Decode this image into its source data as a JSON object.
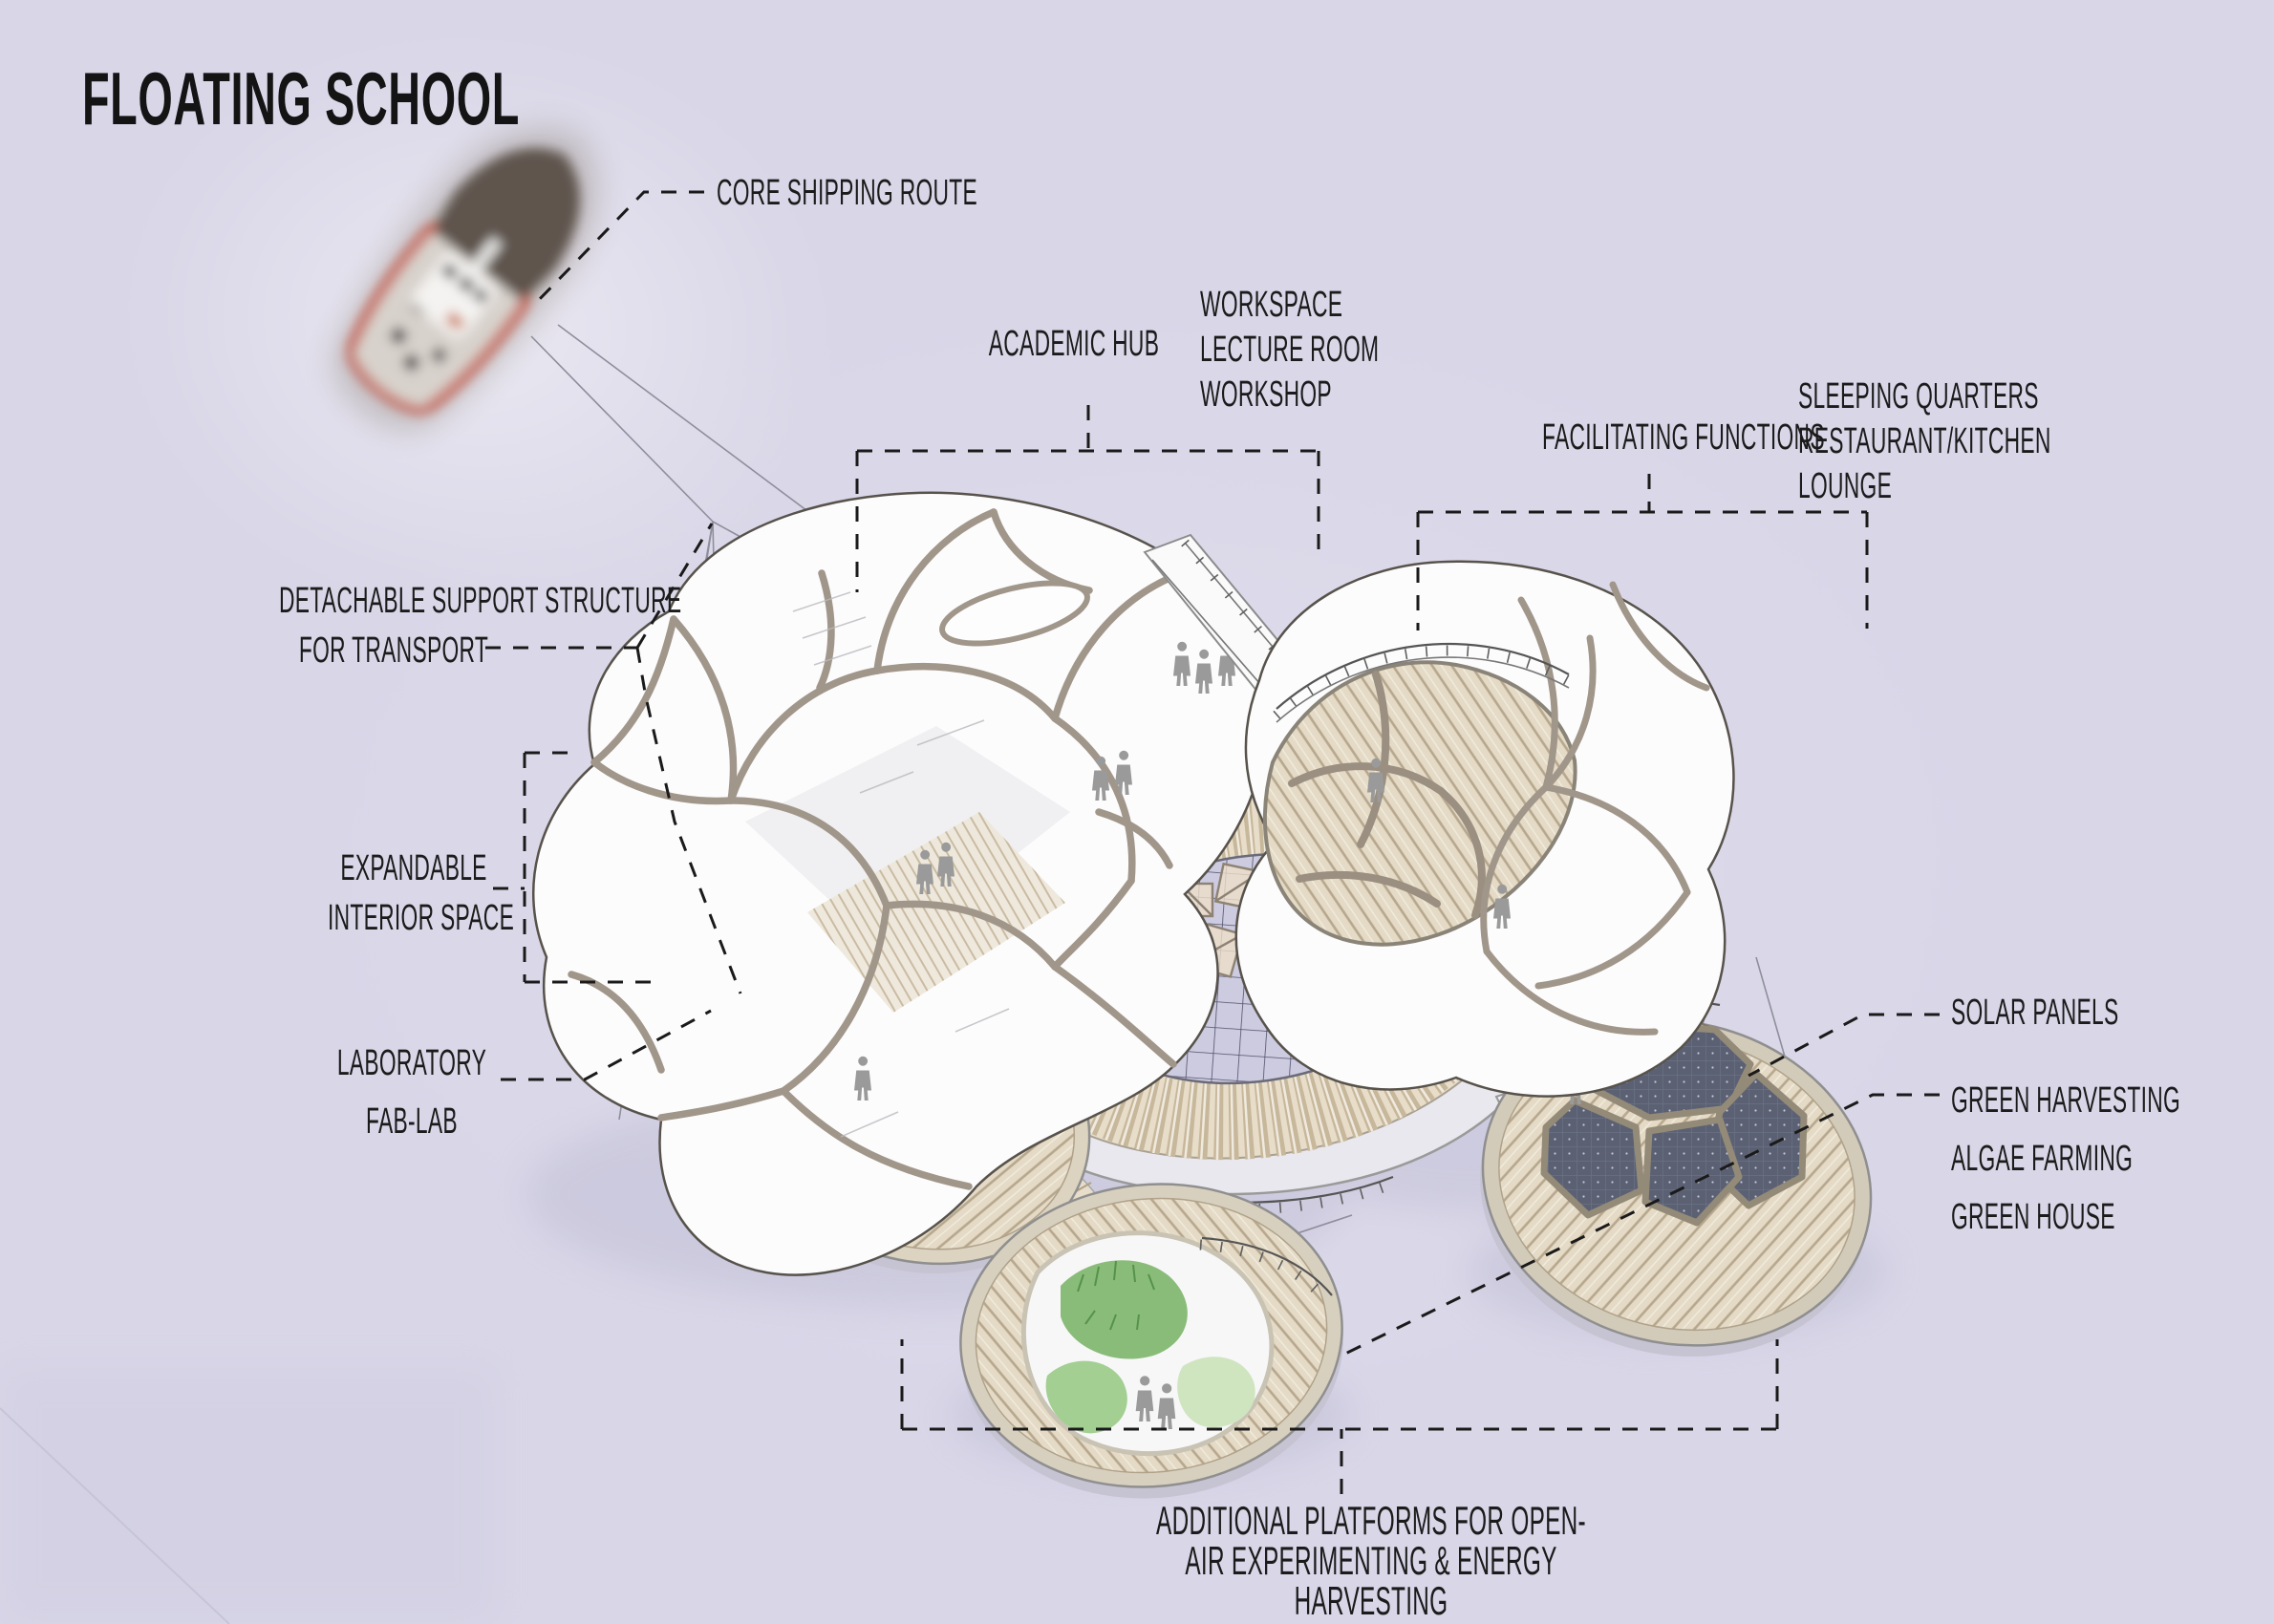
{
  "title": "FLOATING SCHOOL",
  "callouts": {
    "core_shipping_route": "CORE SHIPPING ROUTE",
    "academic_hub": {
      "title": "ACADEMIC HUB",
      "items": [
        "WORKSPACE",
        "LECTURE ROOM",
        "WORKSHOP"
      ]
    },
    "facilitating_functions": {
      "title": "FACILITATING FUNCTIONS",
      "items": [
        "SLEEPING QUARTERS",
        "RESTAURANT/KITCHEN",
        "LOUNGE"
      ]
    },
    "detachable_support": {
      "line1": "DETACHABLE SUPPORT STRUCTURE",
      "line2": "FOR TRANSPORT"
    },
    "expandable_interior": {
      "line1": "EXPANDABLE",
      "line2": "INTERIOR SPACE"
    },
    "laboratory": {
      "line1": "LABORATORY",
      "line2": "FAB-LAB"
    },
    "solar_panels": "SOLAR PANELS",
    "green_functions": {
      "items": [
        "GREEN HARVESTING",
        "ALGAE FARMING",
        "GREEN HOUSE"
      ]
    },
    "bottom_caption": "ADDITIONAL PLATFORMS FOR OPEN-AIR EXPERIMENTING & ENERGY HARVESTING"
  },
  "colors": {
    "background": "#d8d6e7",
    "text": "#1b1b1b",
    "leader_line": "#1a1a1a",
    "pod_frame": "#a1968a",
    "pod_outline": "#57524b",
    "deck_wood": "#e4dac5",
    "deck_seam": "#b6a78e",
    "solar_panel": "#5b6173",
    "greenery": "#8abc79",
    "figure": "#9a9a9a",
    "boat_red": "#c4492f",
    "water_shadow": "#b9b6cf"
  }
}
